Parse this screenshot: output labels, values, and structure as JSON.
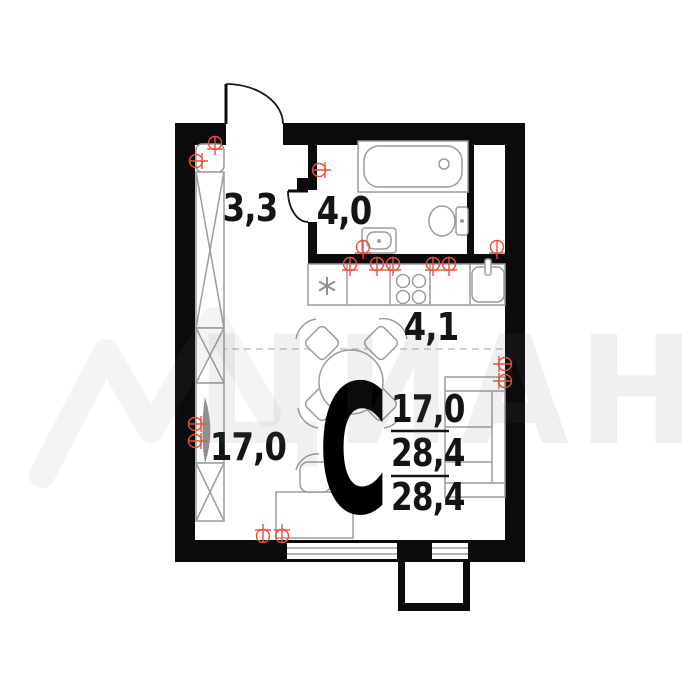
{
  "watermark": {
    "brand": "ЦИАН"
  },
  "plan": {
    "studio_letter": "С",
    "room_labels": {
      "hallway": "3,3",
      "bathroom": "4,0",
      "kitchen": "4,1",
      "living": "17,0"
    },
    "area_stack": {
      "living": "17,0",
      "total": "28,4",
      "total_repeat": "28,4"
    },
    "colors": {
      "wall": "#0b0b0b",
      "furniture_line": "#9c9c9c",
      "outlet_red": "#e8503a",
      "label_text": "#141414",
      "watermark_gray": "#6e6e6e",
      "dashed_zone": "#c4c4c4"
    }
  }
}
